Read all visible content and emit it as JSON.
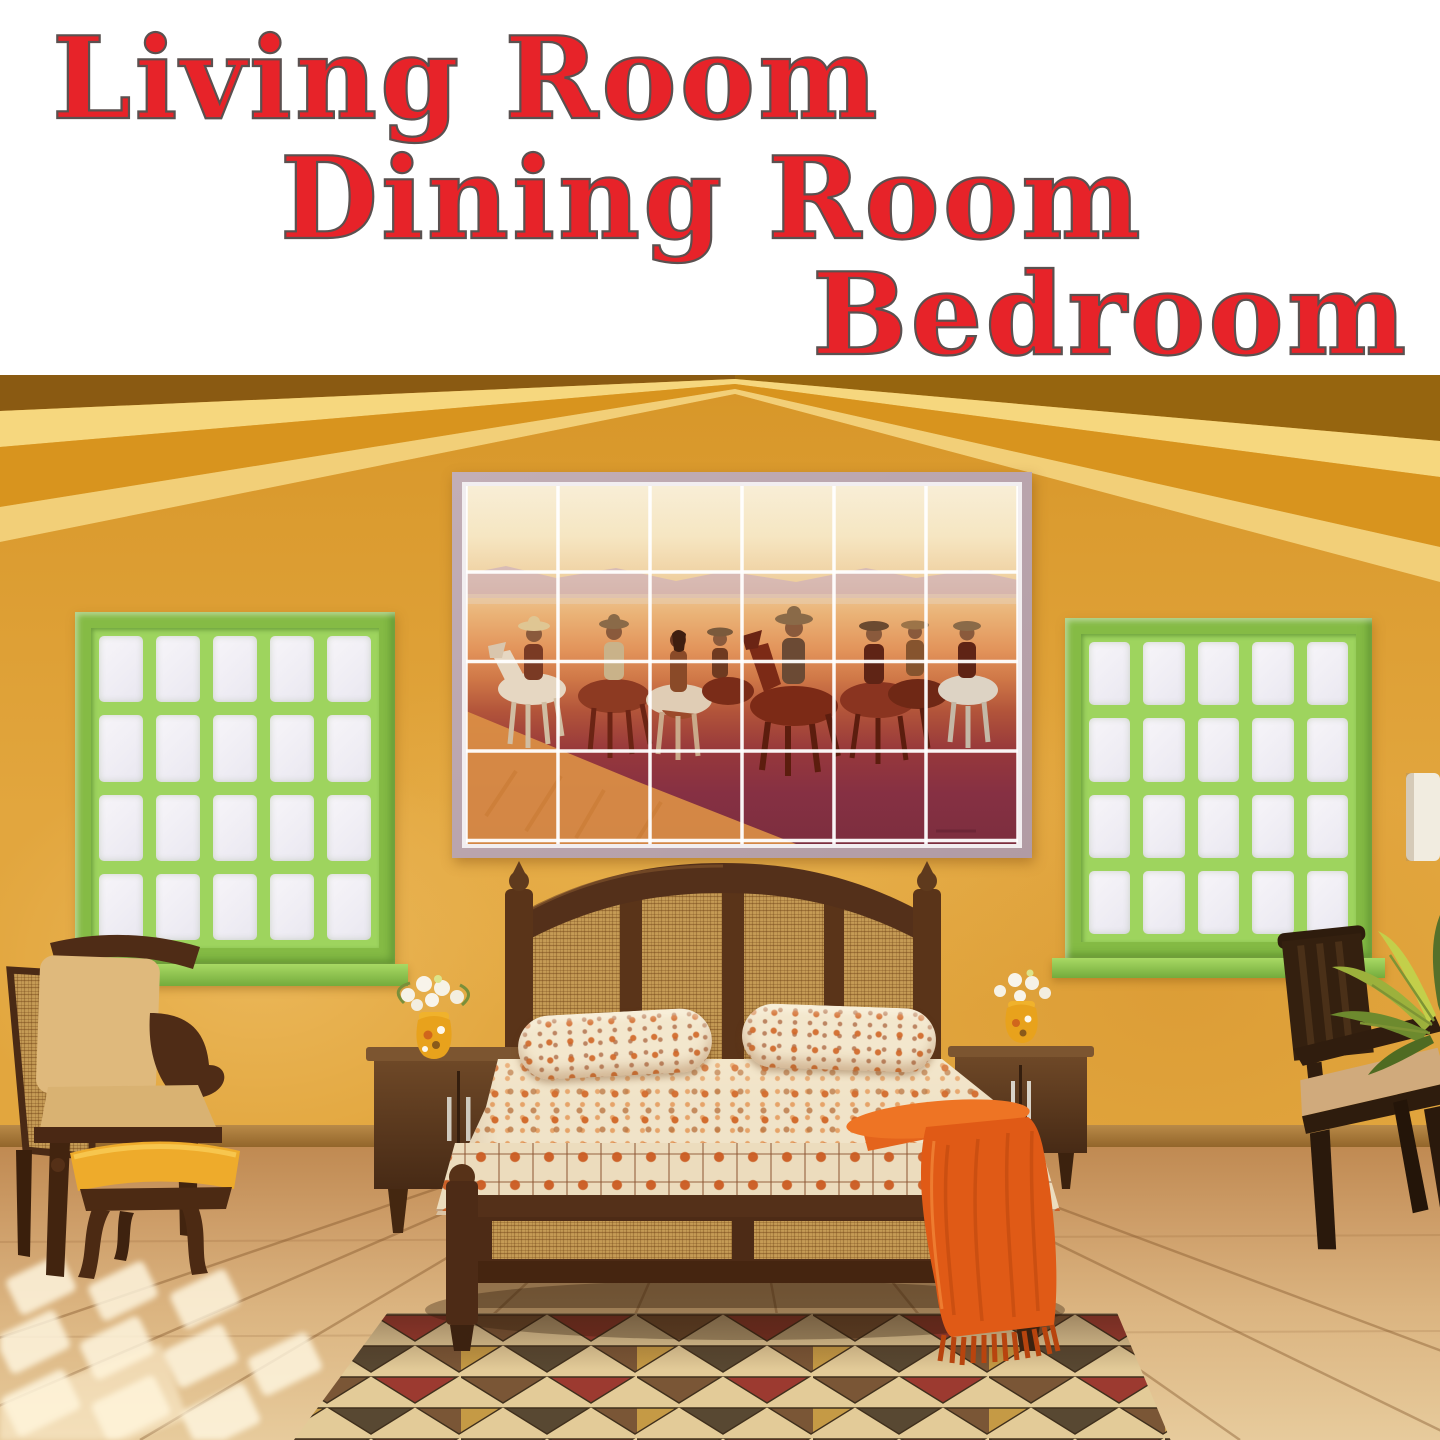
{
  "title": {
    "lines": [
      "Living Room",
      "Dining Room",
      "Bedroom"
    ],
    "color": "#e72329",
    "outline_color": "#5a5150"
  },
  "photo": {
    "description": "bedroom interior with western tile mural above bed",
    "objects": [
      "gabled-ceiling-beams",
      "yellow-plaster-wall",
      "left-paned-window",
      "right-paned-window",
      "cowboy-tile-mural",
      "cane-headboard-bed",
      "patterned-bedspread",
      "two-patterned-pillows",
      "orange-throw-blanket",
      "left-nightstand",
      "right-nightstand",
      "yellow-flower-vase-left",
      "yellow-flower-vase-right",
      "cane-armchair",
      "yellow-footstool",
      "dark-side-chair",
      "potted-plant",
      "white-lampshade",
      "triangle-pattern-rug",
      "wood-plank-floor",
      "sunlight-patches"
    ],
    "palette": {
      "wall": "#e2a63e",
      "gable_shade": "#d18d1c",
      "beam_light": "#f6d77e",
      "beam_mid": "#d8941e",
      "roof_corner": "#8a5a12",
      "window_frame_green": "#85bb45",
      "window_pane": "#f3f1f6",
      "mural_frame": "#b8a4ac",
      "mural_sky": "#f8eed6",
      "mural_field": "#e2935a",
      "mural_grass_dark": "#7c2e3e",
      "wood_dark": "#54301a",
      "cane": "#c59b55",
      "bedding_cream": "#f0e3c8",
      "bedding_orange": "#d16626",
      "throw_orange": "#e05a16",
      "floor_wood": "#dbb480",
      "rug_cream": "#e3cb98",
      "rug_brown": "#7a5636",
      "rug_red": "#9c3a30",
      "rug_dark": "#584832",
      "rug_mustard": "#c59a45",
      "stool_yellow": "#eeab2b",
      "cushion_tan": "#dcb377",
      "vase_yellow": "#e8a21c"
    }
  }
}
